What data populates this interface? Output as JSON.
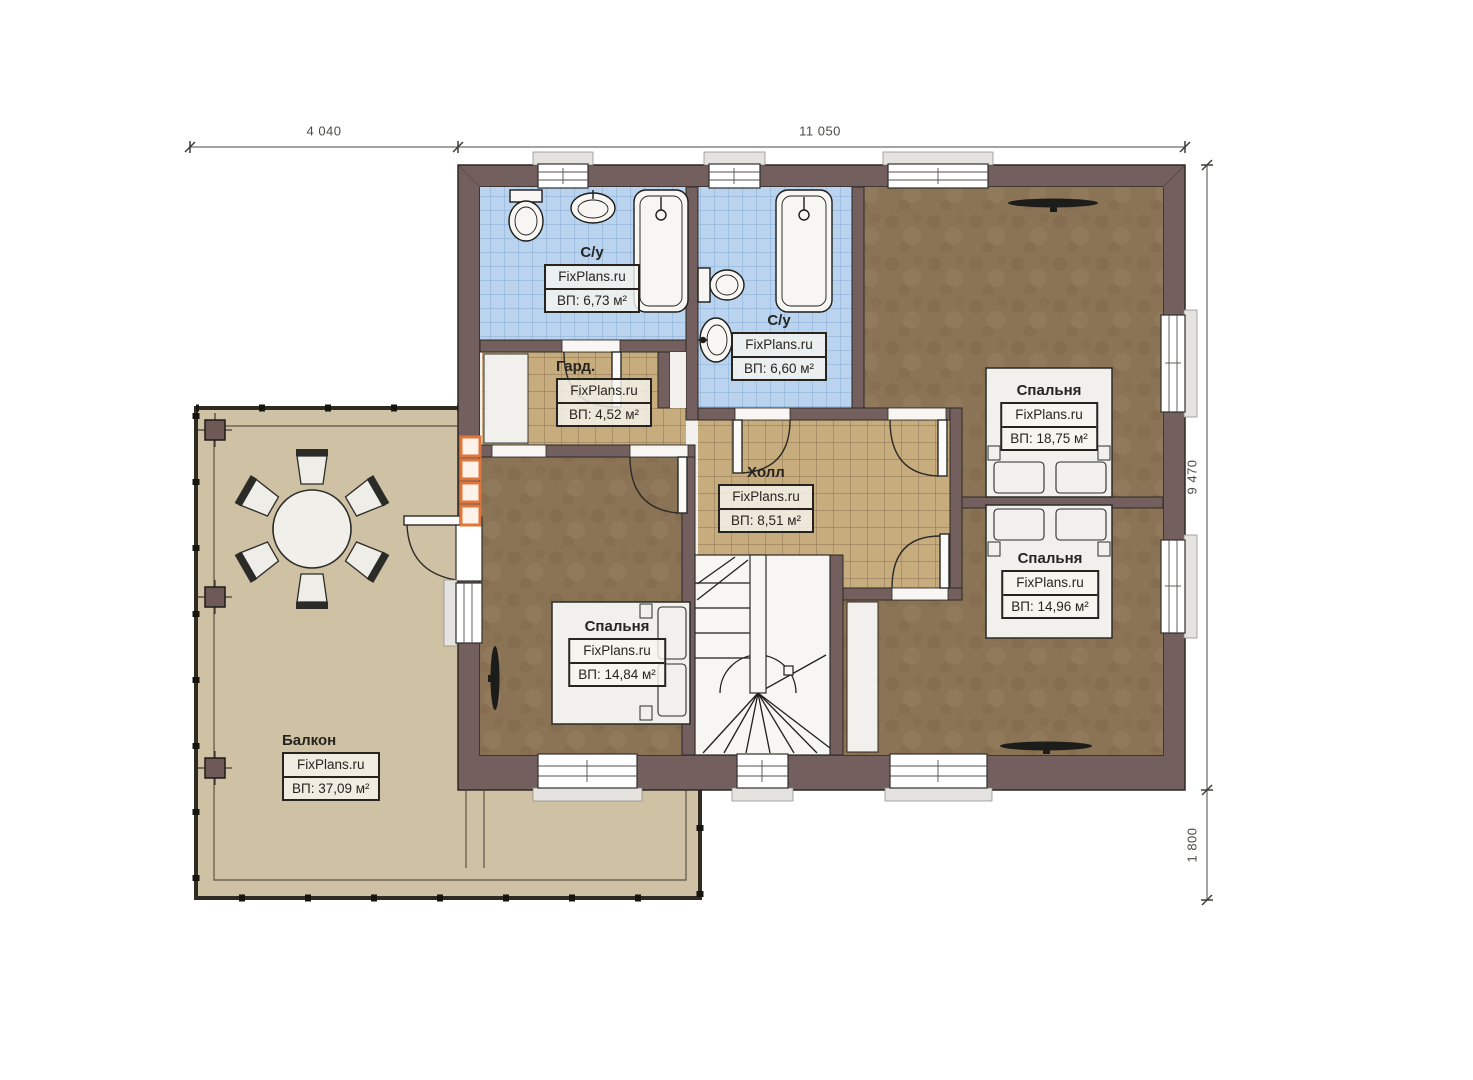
{
  "site_brand": "FixPlans.ru",
  "dimensions": {
    "top_left": "4 040",
    "top_right": "11 050",
    "right_upper": "9 470",
    "right_lower": "1 800"
  },
  "rooms": {
    "bathroom1": {
      "name": "С/у",
      "brand": "FixPlans.ru",
      "area": "ВП: 6,73 м²"
    },
    "bathroom2": {
      "name": "С/у",
      "brand": "FixPlans.ru",
      "area": "ВП: 6,60 м²"
    },
    "wardrobe": {
      "name": "Гард.",
      "brand": "FixPlans.ru",
      "area": "ВП: 4,52 м²"
    },
    "hall": {
      "name": "Холл",
      "brand": "FixPlans.ru",
      "area": "ВП: 8,51 м²"
    },
    "bedroom1": {
      "name": "Спальня",
      "brand": "FixPlans.ru",
      "area": "ВП: 18,75 м²"
    },
    "bedroom2": {
      "name": "Спальня",
      "brand": "FixPlans.ru",
      "area": "ВП: 14,96 м²"
    },
    "bedroom3": {
      "name": "Спальня",
      "brand": "FixPlans.ru",
      "area": "ВП: 14,84 м²"
    },
    "balcony": {
      "name": "Балкон",
      "brand": "FixPlans.ru",
      "area": "ВП: 37,09 м²"
    }
  },
  "colors": {
    "wall": "#73605e",
    "tile_blue": "#bad4f0",
    "tile_tan": "#c7ac7e",
    "carpet": "#8b7355",
    "balcony_floor": "#cfc1a3",
    "railing": "#2e2b22",
    "accent_orange": "#e0763a",
    "fixture_white": "#f7f6f3"
  }
}
